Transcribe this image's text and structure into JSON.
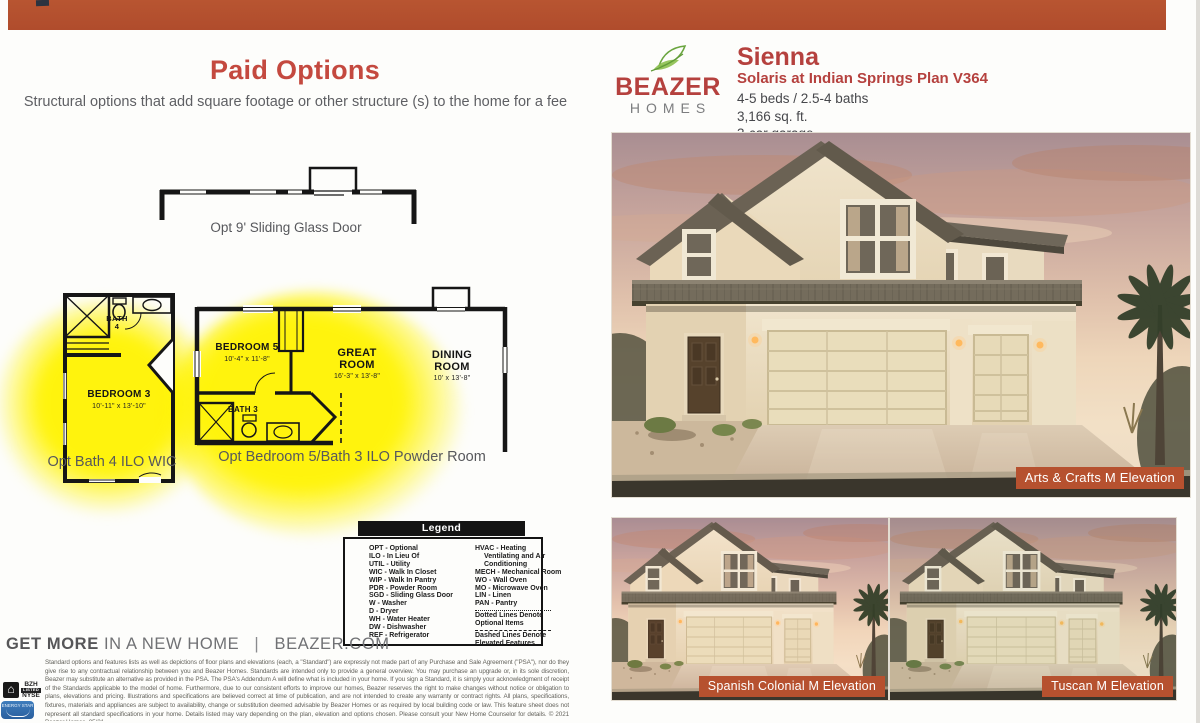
{
  "header": {
    "title": "Paid Options",
    "subtitle": "Structural options that add square footage or other structure (s) to the home for a fee"
  },
  "brand": {
    "name_top": "BEAZER",
    "name_bottom": "HOMES"
  },
  "plan": {
    "name": "Sienna",
    "community": "Solaris at Indian Springs Plan V364",
    "beds_baths": "4-5 beds / 2.5-4 baths",
    "area": "3,166 sq. ft.",
    "garage": "3-car garage"
  },
  "options": {
    "sgd_caption": "Opt 9' Sliding Glass Door",
    "bath4_caption": "Opt Bath 4 ILO WIC",
    "bed5_caption": "Opt Bedroom 5/Bath 3 ILO Powder Room"
  },
  "rooms": {
    "bath4_line1": "BATH",
    "bath4_line2": "4",
    "bedroom3": "BEDROOM 3",
    "bedroom3_dims": "10'-11\" x 13'-10\"",
    "bedroom5": "BEDROOM 5",
    "bedroom5_dims": "10'-4\" x 11'-8\"",
    "great_l1": "GREAT",
    "great_l2": "ROOM",
    "great_dims": "16'-3\" x 13'-8\"",
    "dining_l1": "DINING",
    "dining_l2": "ROOM",
    "dining_dims": "10' x 13'-8\"",
    "bath3": "BATH 3"
  },
  "legend": {
    "title": "Legend",
    "left": [
      "OPT - Optional",
      "ILO - In Lieu Of",
      "UTIL - Utility",
      "WIC - Walk In Closet",
      "WIP - Walk In Pantry",
      "PDR - Powder Room",
      "SGD - Sliding Glass Door",
      "W - Washer",
      "D - Dryer",
      "WH - Water Heater",
      "DW - Dishwasher",
      "REF - Refrigerator"
    ],
    "right": [
      "HVAC - Heating Ventilating and Air Conditioning",
      "MECH - Mechanical Room",
      "WO - Wall Oven",
      "MO - Microwave Oven",
      "LIN - Linen",
      "PAN - Pantry"
    ],
    "dotted_note": "Dotted Lines Denote Optional Items",
    "dashed_note": "Dashed Lines Denote Elevated Features"
  },
  "footer": {
    "tagline_bold": "GET MORE",
    "tagline_rest": "IN A NEW HOME",
    "divider": "|",
    "site": "BEAZER.COM",
    "ticker_top": "BZH",
    "ticker_mid": "LISTED",
    "ticker_bottom": "NYSE",
    "equal_housing_glyph": "⌂",
    "energy_label": "ENERGY STAR"
  },
  "disclaimer": "Standard options and features lists as well as depictions of floor plans and elevations (each, a \"Standard\") are expressly not made part of any Purchase and Sale Agreement (\"PSA\"), nor do they give rise to any contractual relationship between you and Beazer Homes. Standards are intended only to provide a general overview. You may purchase an upgrade or, in its sole discretion, Beazer may substitute an alternative as provided in the PSA. The PSA's Addendum A will define what is included in your home. If you sign a Standard, it is simply your acknowledgment of receipt of the Standards applicable to the model of home. Furthermore, due to our consistent efforts to improve our homes, Beazer reserves the right to make changes without notice or obligation to plans, elevations and pricing. Illustrations and specifications are believed correct at time of publication, and are not intended to create any warranty or contract rights. All plans, specifications, fixtures, materials and appliances are subject to availability, change or substitution deemed advisable by Beazer Homes or as required by local building code or law. This feature sheet does not represent all standard specifications in your home. Details listed may vary depending on the plan, elevation and options chosen. Please consult your New Home Counselor for details. © 2021 Beazer Homes. 05/21",
  "elevations": [
    {
      "label": "Arts & Crafts M Elevation"
    },
    {
      "label": "Spanish Colonial M Elevation"
    },
    {
      "label": "Tuscan M Elevation"
    }
  ],
  "colors": {
    "bar_rust": "#b5502e",
    "accent_red": "#b5413e",
    "badge_rust": "#b6512f",
    "highlight_yellow": "#fff300"
  }
}
